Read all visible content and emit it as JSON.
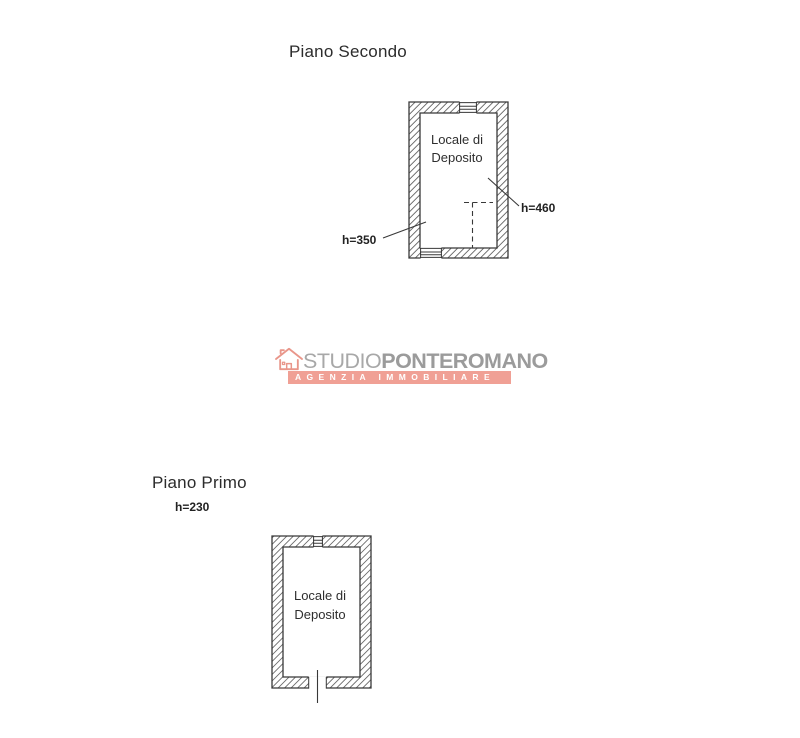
{
  "document": {
    "type": "scanned floor plan",
    "background": "#ffffff",
    "line_color": "#383838",
    "hatch_color": "#6b6b6b"
  },
  "floor_plans": [
    {
      "id": "piano-secondo",
      "title": "Piano Secondo",
      "room_label_line1": "Locale di",
      "room_label_line2": "Deposito",
      "dimensions": [
        {
          "label": "h=350"
        },
        {
          "label": "h=460"
        }
      ]
    },
    {
      "id": "piano-primo",
      "title": "Piano Primo",
      "height_note": "h=230",
      "room_label_line1": "Locale di",
      "room_label_line2": "Deposito"
    }
  ],
  "watermark": {
    "icon": "house-icon",
    "brand_prefix": "STUDIO",
    "brand_suffix": "PONTEROMANO",
    "tagline": "AGENZIA IMMOBILIARE",
    "colors": {
      "brand_prefix_text": "#a8a8a8",
      "brand_suffix_text": "#9b9b9b",
      "bar_background": "#f0a095",
      "bar_text": "#ffffff",
      "icon_stroke": "#e9968a"
    }
  }
}
